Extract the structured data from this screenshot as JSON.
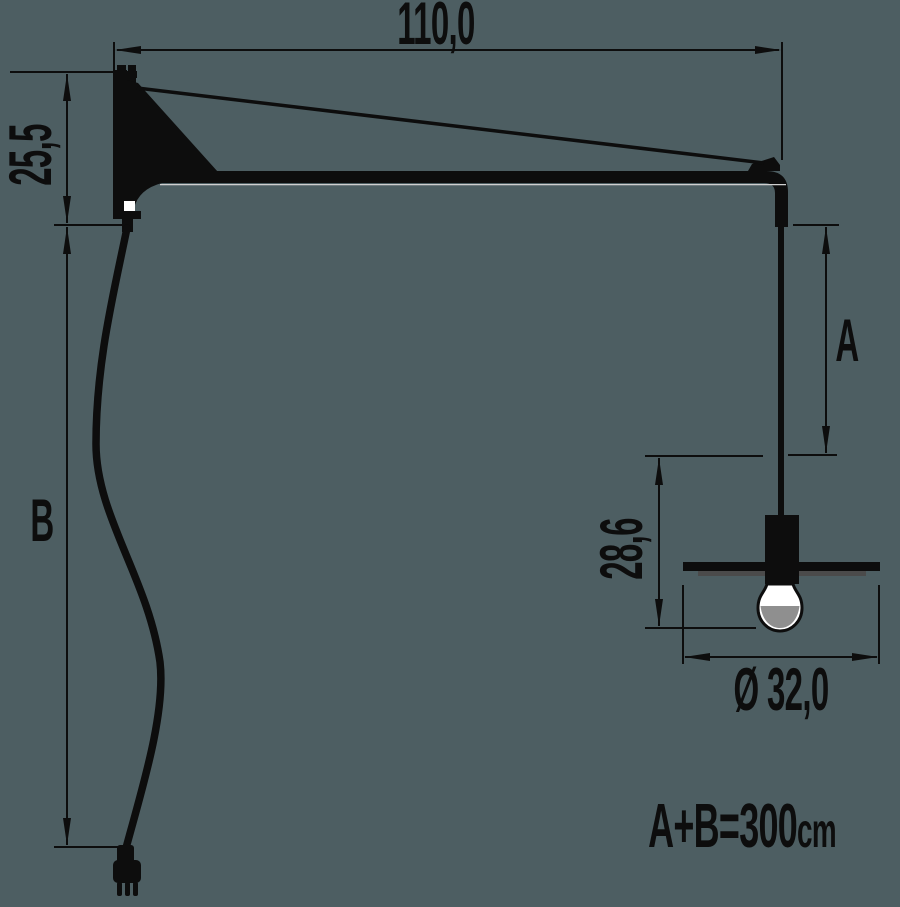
{
  "labels": {
    "arm_length": "110,0",
    "plate_height": "25,5",
    "upper_cord": "B",
    "drop_rod": "A",
    "head_height": "28,6",
    "shade_diameter": "Ø 32,0",
    "formula_value": "A+B=300",
    "formula_unit": "cm"
  },
  "colors": {
    "background": "#4d5e62",
    "ink": "#0d0d0d",
    "shade_shadow": "#4b4b4b",
    "bulb_gray": "#8f8f8f",
    "highlight": "#cfcfcf",
    "white": "#ffffff"
  }
}
